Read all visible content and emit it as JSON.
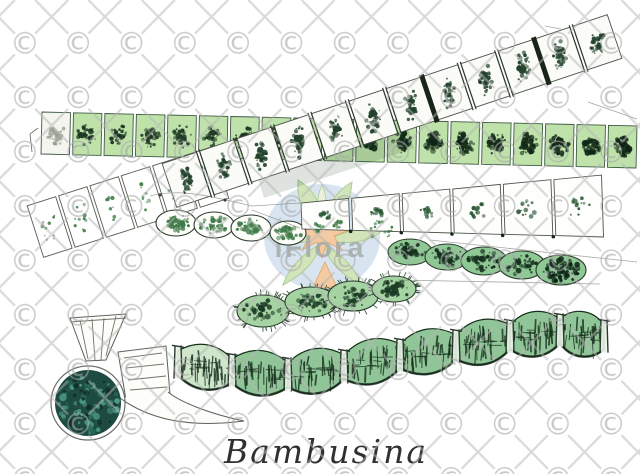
{
  "canvas": {
    "width": 640,
    "height": 474,
    "background": "#ffffff"
  },
  "caption": {
    "text": "Bambusina"
  },
  "watermark": {
    "symbol": "©",
    "logo_text": "iFlora",
    "colors": {
      "symbol_gray": "#a9a9a9",
      "line_gray": "#b5b5b5",
      "logo_circle": "#d5e3f0",
      "logo_leaf": "#cfe2b5",
      "logo_leaf_edge": "#a7c98c",
      "logo_accent": "#f2c69a",
      "logo_accent_edge": "#e29d57",
      "logo_text_color": "#99a19d"
    }
  },
  "figure": {
    "ink": "#1f1f1f",
    "bands": [
      {
        "id": "upper-horizontal-filament",
        "x1": 40,
        "y1": 133,
        "x2": 638,
        "y2": 147,
        "h": 42,
        "cells": 19,
        "fill": "#bfe2aa",
        "blob": "#1d3522",
        "stroke": "#3f5a43",
        "paleFirst": true,
        "darkRight": true,
        "bw": 0.3,
        "bh": 0.5
      },
      {
        "id": "ascending-left-filament",
        "x1": 34,
        "y1": 232,
        "x2": 222,
        "y2": 172,
        "h": 54,
        "cells": 6,
        "fill": "#ffffff",
        "blob": "#47824d",
        "stroke": "#565f52",
        "sparse": true,
        "bw": 0.22,
        "bh": 0.52
      },
      {
        "id": "diagonal-filament",
        "x1": 168,
        "y1": 186,
        "x2": 616,
        "y2": 36,
        "h": 46,
        "cells": 12,
        "fill": "#fbfcf7",
        "blob": "#20402a",
        "stroke": "#49544a",
        "joints": "double",
        "thick": [
          7,
          10
        ],
        "bw": 0.18,
        "bh": 0.62
      },
      {
        "id": "widening-box-filament",
        "x1": 300,
        "y1": 216,
        "x2": 604,
        "y2": 206,
        "h1": 26,
        "h2": 62,
        "cells": 6,
        "fill": "#fefefc",
        "blob": "#2c5a36",
        "stroke": "#4a5547",
        "dotgrow": true,
        "knots": true
      }
    ],
    "oval_chains": [
      {
        "id": "boxed-ovals",
        "fill": "#fdfdfa",
        "blob": "#3f7a47",
        "outline": true,
        "ovals": [
          [
            176,
            223,
            20,
            13
          ],
          [
            214,
            225,
            20,
            13
          ],
          [
            251,
            228,
            20,
            13
          ],
          [
            288,
            233,
            18,
            12
          ]
        ]
      },
      {
        "id": "tube-ovals",
        "fill": "#8fc795",
        "blob": "#15301e",
        "darkLast": true,
        "ovals": [
          [
            410,
            252,
            22,
            13
          ],
          [
            447,
            257,
            22,
            13
          ],
          [
            484,
            261,
            23,
            14
          ],
          [
            522,
            265,
            23,
            14
          ],
          [
            561,
            270,
            25,
            15
          ]
        ]
      },
      {
        "id": "spiny-ovals",
        "fill": "#a5d4a2",
        "blob": "#1c3a25",
        "spines": true,
        "ovals": [
          [
            263,
            311,
            26,
            16
          ],
          [
            311,
            302,
            26,
            15
          ],
          [
            353,
            296,
            25,
            15
          ],
          [
            394,
            289,
            22,
            13
          ]
        ]
      }
    ],
    "extra_blobs": [
      [
        318,
        228,
        6,
        5
      ],
      [
        338,
        224,
        5,
        4
      ],
      [
        381,
        229,
        13,
        10
      ]
    ],
    "bamboo": {
      "points": [
        [
          178,
          363
        ],
        [
          232,
          371
        ],
        [
          288,
          375
        ],
        [
          344,
          367
        ],
        [
          400,
          356
        ],
        [
          456,
          347
        ],
        [
          510,
          337
        ],
        [
          560,
          331
        ],
        [
          604,
          337
        ]
      ],
      "h": 44,
      "fill": "#90c697",
      "ink": "#17301d",
      "paleFill": "#cfe6cb"
    },
    "basal": {
      "cx": 88,
      "cy": 403,
      "r": 33,
      "fill": "#1d4a41",
      "light": "#4f9c85",
      "mid": "#2a6b58",
      "dark": "#0e2a22"
    }
  }
}
